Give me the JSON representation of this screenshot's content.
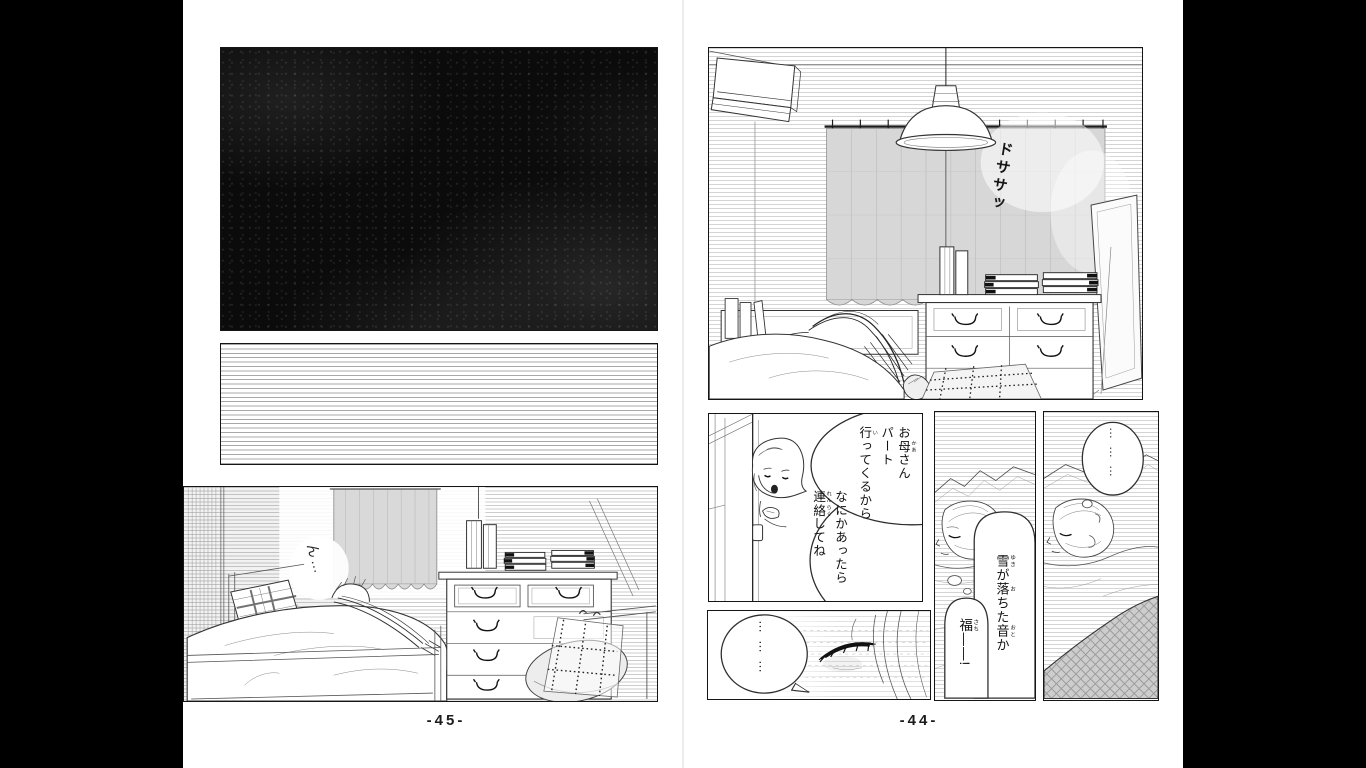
{
  "viewer": {
    "background_color": "#000000",
    "page_color": "#ffffff"
  },
  "colors": {
    "ink": "#1a1a1a",
    "hatch_line": "#b5b5b5",
    "curtain_gray": "#d7d7d7",
    "dark_panel": "#0b0b0b"
  },
  "left_page": {
    "page_number": "-45-",
    "sfx_sleep": "ん…"
  },
  "right_page": {
    "page_number": "-44-",
    "sfx_thud": "ドササッ",
    "speech": {
      "mother_1": [
        [
          [
            "お"
          ],
          [
            "母",
            "かあ"
          ],
          [
            "さん"
          ]
        ],
        [
          [
            "パート"
          ]
        ],
        [
          [
            "行",
            "い"
          ],
          [
            "ってくるから"
          ]
        ]
      ],
      "mother_2": [
        [
          [
            "なにかあったら"
          ]
        ],
        [
          [
            "連",
            "れん"
          ],
          [
            "絡",
            "らく"
          ],
          [
            "してね"
          ]
        ]
      ],
      "snow": [
        [
          [
            "雪",
            "ゆき"
          ],
          [
            "が"
          ],
          [
            "落",
            "お"
          ],
          [
            "ちた"
          ],
          [
            "音",
            "おと"
          ],
          [
            "か"
          ]
        ]
      ],
      "fuku": [
        [
          [
            "福",
            "さち"
          ],
          [
            "——!"
          ]
        ]
      ],
      "silence_dots": "………",
      "sleep_dots": "………"
    }
  }
}
